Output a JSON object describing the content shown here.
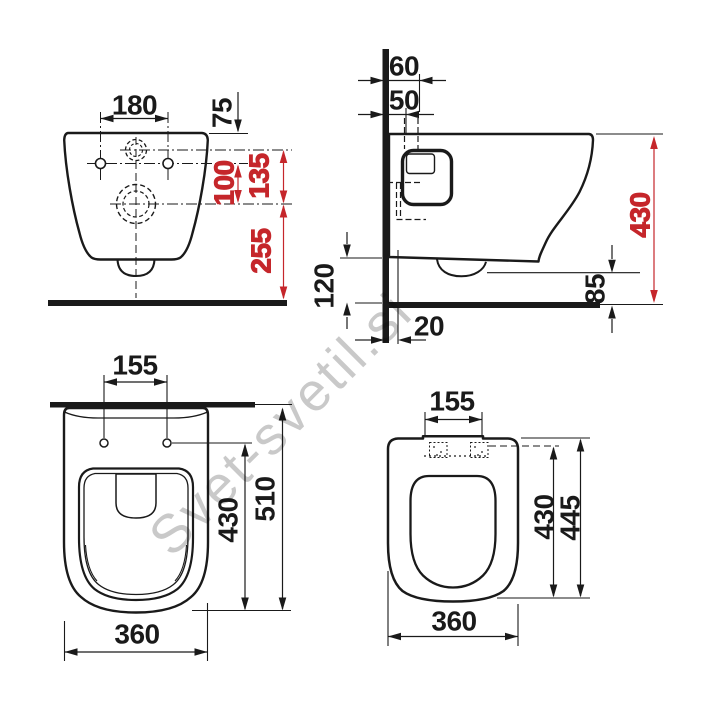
{
  "watermark": "Svet-svetil.si",
  "colors": {
    "ink": "#1a1a1a",
    "accent_red": "#c5262b",
    "watermark_gray": "#c9c9c9"
  },
  "views": {
    "front": {
      "dims": {
        "holes_span": "180",
        "rim_to_holes": "75",
        "inlet_to_drain": "135",
        "holes_to_drain": "100",
        "drain_to_floor": "255"
      }
    },
    "side": {
      "dims": {
        "inlet_offset": "60",
        "flush_offset": "50",
        "overall_height": "430",
        "underside_clearance": "120",
        "outlet_clearance": "85",
        "drain_offset": "20"
      }
    },
    "bowl_plan": {
      "dims": {
        "holes_span": "155",
        "overall_depth": "510",
        "holes_to_front": "430",
        "width": "360"
      }
    },
    "seat_plan": {
      "dims": {
        "hinge_span": "155",
        "hinge_to_front": "430",
        "overall_depth": "445",
        "width": "360"
      }
    }
  }
}
